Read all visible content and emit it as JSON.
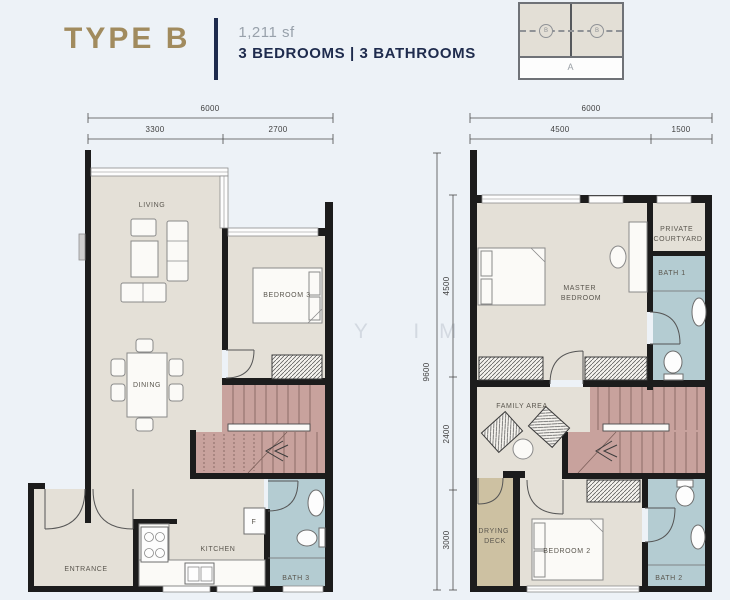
{
  "header": {
    "type_label": "TYPE B",
    "area": "1,211 sf",
    "spec": "3 BEDROOMS | 3 BATHROOMS",
    "key_plan": {
      "markers": [
        "B",
        "B"
      ],
      "row_label": "A"
    }
  },
  "watermark": "SHIRLEY IM",
  "colors": {
    "accent_gold": "#a18b5e",
    "navy": "#1e2b4d",
    "floor_beige": "#e4e0d7",
    "stairs_pink": "#c8a29d",
    "bathroom_teal": "#b4ccd2",
    "deck_tan": "#cdc1a2",
    "background": "#edf2f7",
    "wall": "#1c1c1c"
  },
  "plans": {
    "lower": {
      "dims_top": {
        "total": "6000",
        "segments": [
          "3300",
          "2700"
        ]
      },
      "rooms": {
        "living": "LIVING",
        "dining": "DINING",
        "bedroom3": "BEDROOM 3",
        "kitchen": "KITCHEN",
        "entrance": "ENTRANCE",
        "bath3": "BATH 3",
        "fridge": "F"
      }
    },
    "upper": {
      "dims_top": {
        "total": "6000",
        "segments": [
          "4500",
          "1500"
        ]
      },
      "dims_left": {
        "total": "9600",
        "segments": [
          "4500",
          "2400",
          "3000"
        ]
      },
      "rooms": {
        "master": [
          "MASTER",
          "BEDROOM"
        ],
        "courtyard": [
          "PRIVATE",
          "COURTYARD"
        ],
        "bath1": "BATH 1",
        "family": "FAMILY AREA",
        "drying": [
          "DRYING",
          "DECK"
        ],
        "bedroom2": "BEDROOM 2",
        "bath2": "BATH 2"
      }
    }
  }
}
